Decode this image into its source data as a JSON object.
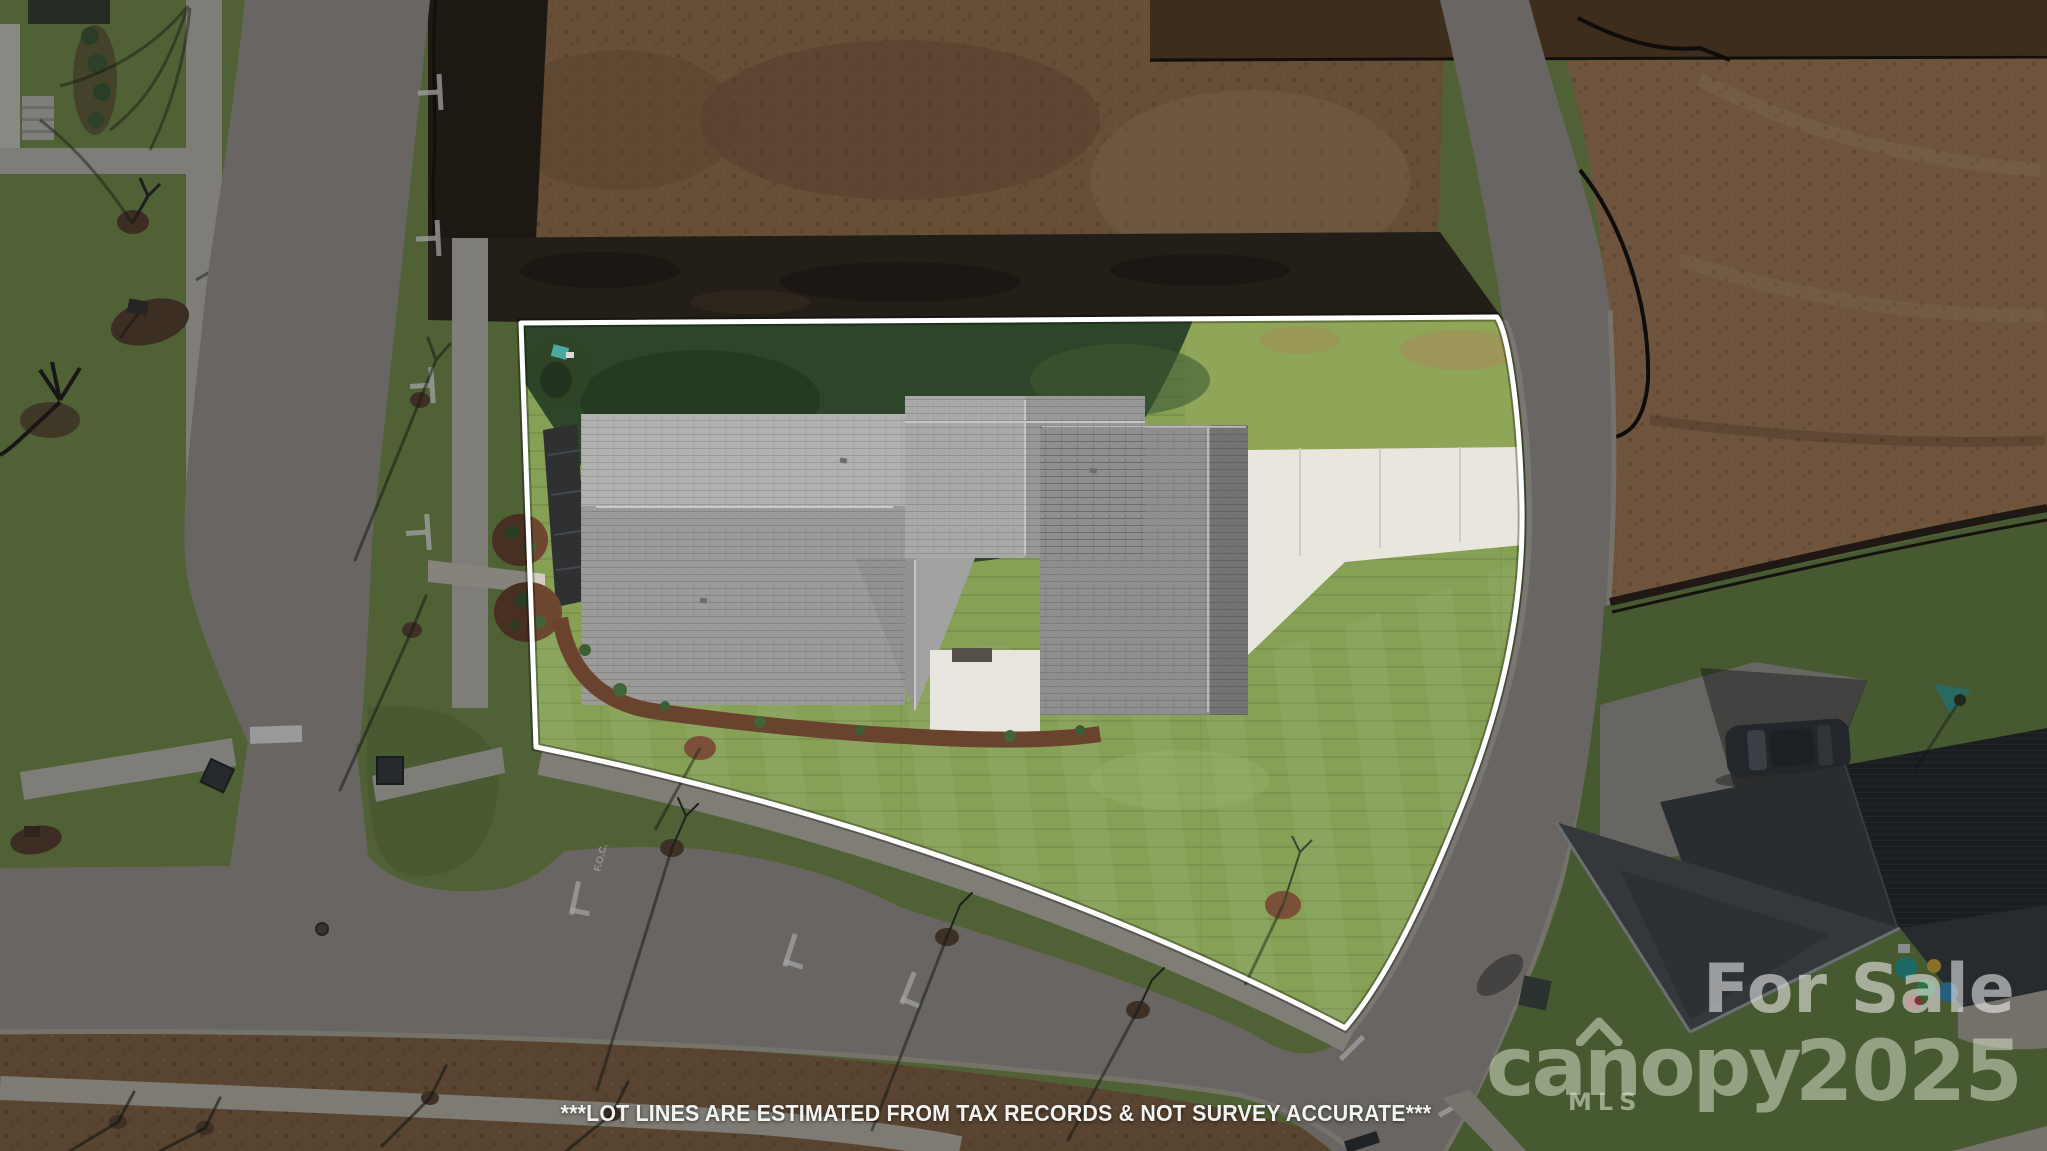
{
  "photo": {
    "watermark": {
      "for_sale": "For Sale",
      "brand": "canopy",
      "brand_sub": "MLS",
      "year": "2025"
    },
    "disclaimer": "***LOT LINES ARE ESTIMATED FROM TAX RECORDS & NOT SURVEY ACCURATE***",
    "road_marking": "F.O.C.",
    "colors": {
      "lot_line": "#ffffff",
      "watermark_white": "rgba(255,255,255,0.52)",
      "brand_tint": "rgba(226,234,212,0.50)",
      "grass": "#86a055",
      "grass_shadow": "#2d4529",
      "dirt": "#a1794f",
      "asphalt": "#a39d96",
      "roof_shingle": "#a8a8a6",
      "concrete_driveway": "#e9e6de"
    }
  }
}
